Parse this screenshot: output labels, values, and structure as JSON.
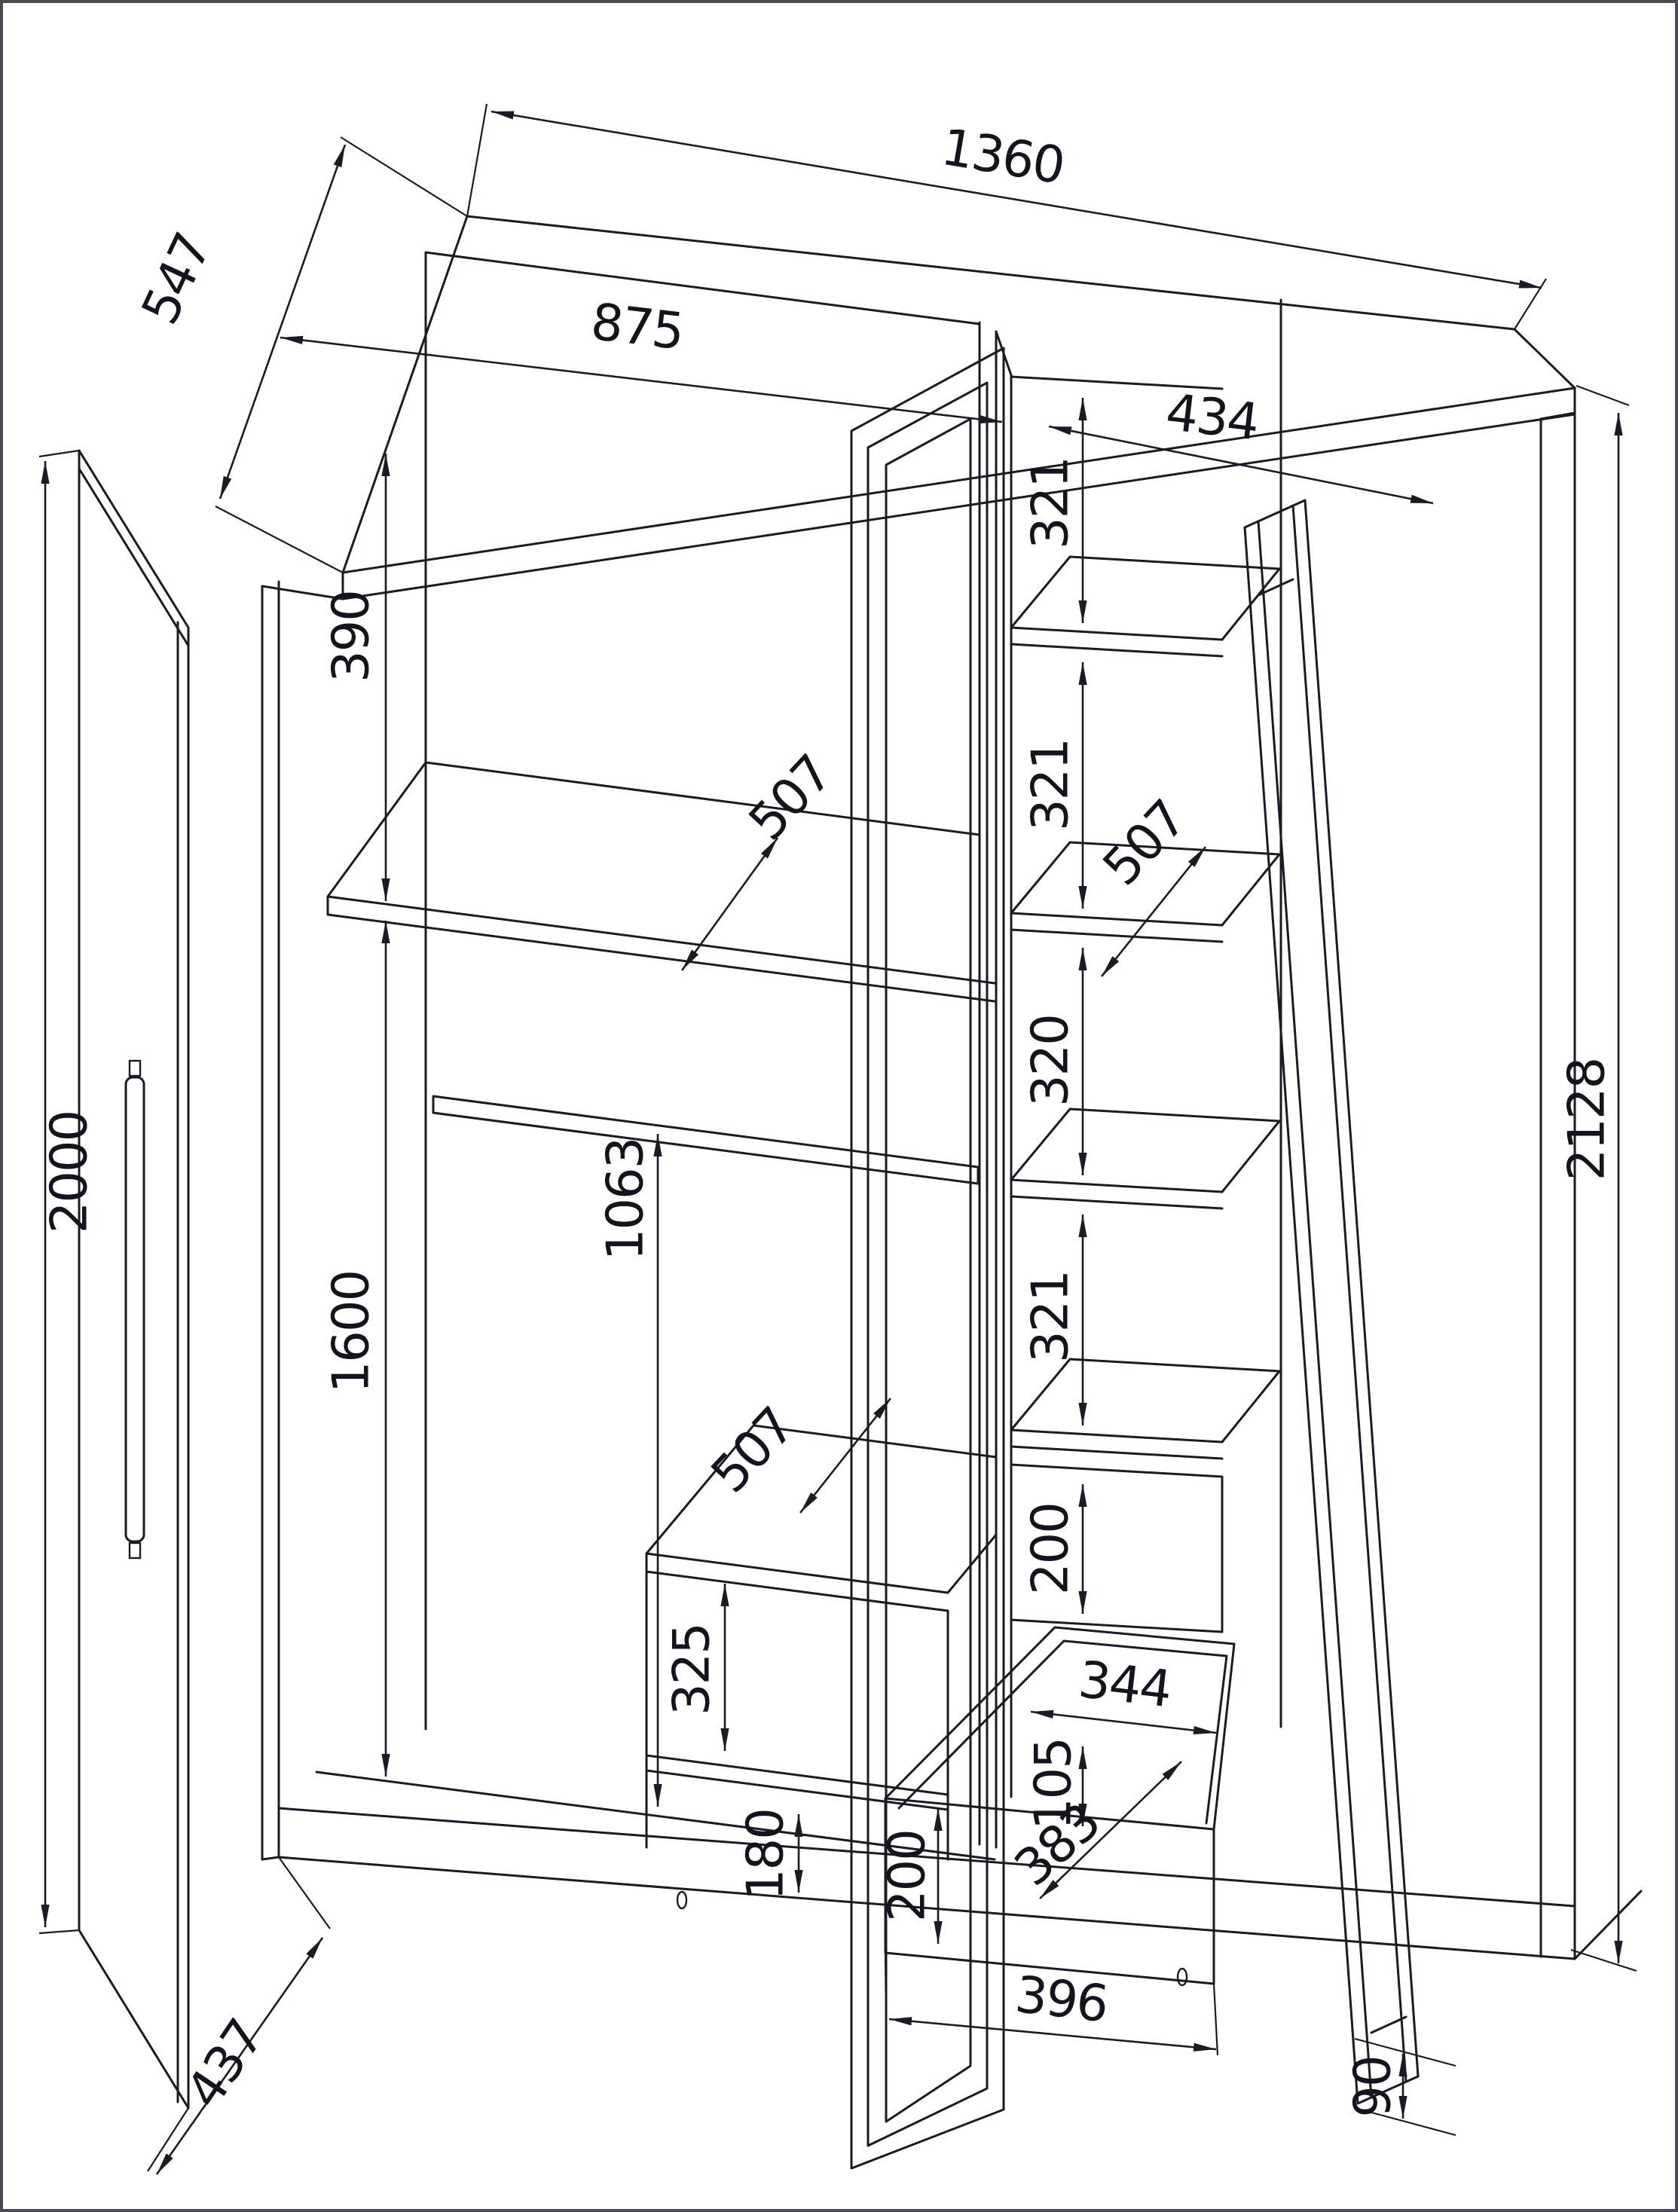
{
  "drawing": {
    "kind": "wardrobe assembly dimensional drawing",
    "dims": {
      "top_depth": "547",
      "total_width": "1360",
      "left_width": "875",
      "right_width": "434",
      "top_gap": "390",
      "shelf_depth_top": "507",
      "rc_gap1": "321",
      "rc_gap2": "321",
      "rc_depth": "507",
      "rc_gap3": "320",
      "rc_gap4": "321",
      "rc_drawer_h": "200",
      "rod_height": "1063",
      "left_tall": "1600",
      "door_height": "2000",
      "ls_depth": "507",
      "ls_gap1": "325",
      "ls_gap2": "180",
      "door_bottom_depth": "437",
      "bd_width_top": "344",
      "bd_back_h": "105",
      "bd_depth": "383",
      "bd_front_h": "200",
      "bd_width_bottom": "396",
      "total_height": "2128",
      "base_height": "90"
    }
  }
}
